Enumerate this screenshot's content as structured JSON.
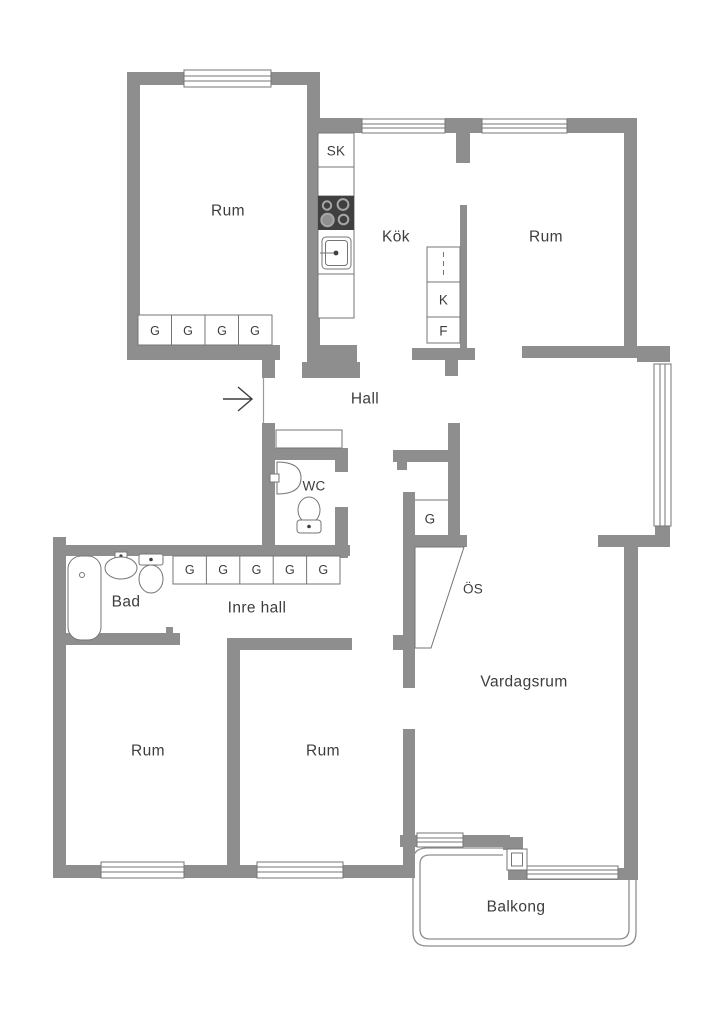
{
  "colors": {
    "background": "#ffffff",
    "wall": "#8e8e8e",
    "line": "#757575",
    "text": "#3d3d3d",
    "fixture_dark": "#3f3f3f"
  },
  "floorplan": {
    "rooms": {
      "room_top_left": "Rum",
      "kitchen": "Kök",
      "room_top_right": "Rum",
      "hall": "Hall",
      "wc": "WC",
      "bathroom": "Bad",
      "inner_hall": "Inre hall",
      "living_room": "Vardagsrum",
      "room_bottom_left": "Rum",
      "room_bottom_mid": "Rum",
      "balcony": "Balkong"
    },
    "fixtures": {
      "closet_sk": "SK",
      "fridge": "K",
      "freezer": "F",
      "closet_g": "G",
      "fireplace": "ÖS",
      "wardrobes_top_room": [
        "G",
        "G",
        "G",
        "G"
      ],
      "wardrobes_inner_hall": [
        "G",
        "G",
        "G",
        "G",
        "G"
      ]
    }
  }
}
